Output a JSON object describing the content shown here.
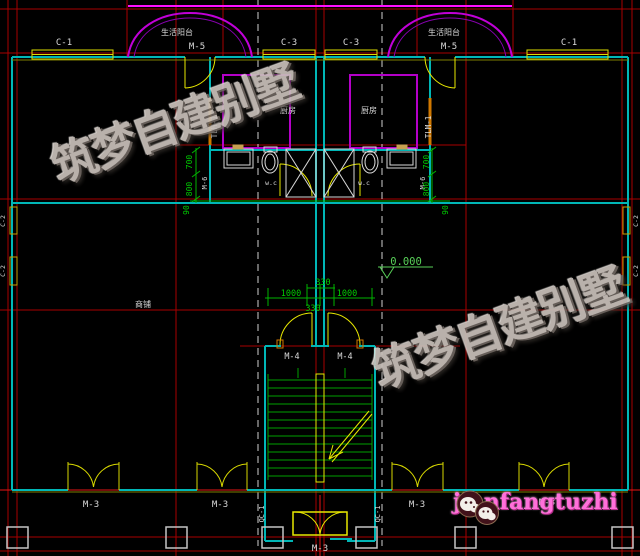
{
  "palette": {
    "background": "#000000",
    "grid_red": "#a80000",
    "bright_red": "#e81616",
    "wall_cyan": "#00b6b6",
    "window_yellow": "#dede00",
    "door_orange": "#d07800",
    "dim_green": "#00b400",
    "balcony_magenta": "#c000d8",
    "accent_magenta": "#ff10ff",
    "text_white": "#dadada",
    "watermark_gray": "#c7bfb9",
    "logo_pink": "#ff70da",
    "column_gray": "#c4c4c4"
  },
  "top": {
    "c1_left": "C-1",
    "balcony_left": "生活阳台",
    "m5_left": "M-5",
    "c3_left": "C-3",
    "c3_right": "C-3",
    "balcony_right": "生活阳台",
    "m5_right": "M-5",
    "c1_right": "C-1"
  },
  "rooms": {
    "kitchen_left": "厨房",
    "kitchen_right": "厨房",
    "shop": "商铺",
    "wc_left": "w.c",
    "wc_right": "w.c"
  },
  "doors": {
    "tlm_left": "TLM-1",
    "tlm_right": "TLM-1",
    "m6_left": "M-6",
    "m6_right": "M-6",
    "m4_left": "M-4",
    "m4_right": "M-4",
    "m3_1": "M-3",
    "m3_2": "M-3",
    "m3_3": "M-3",
    "m3_4": "M-3",
    "m3_center": "M-3",
    "qc_left": "QC-1",
    "qc_right": "QC-1"
  },
  "side_windows": {
    "left_upper": "C-2",
    "left_lower": "C-2",
    "right_upper": "C-2",
    "right_lower": "C-2"
  },
  "dims": {
    "left_700": "700",
    "left_800": "800",
    "left_90": "90",
    "right_700": "700",
    "right_800": "800",
    "right_90": "90",
    "center_330_top": "330",
    "center_1000_left": "1000",
    "center_1000_right": "1000",
    "center_330_bottom": "330",
    "level": "0.000"
  },
  "watermarks": {
    "text1": "筑梦自建别墅",
    "text2": "筑梦自建别墅"
  },
  "logo": {
    "text": "jianfangtuzhi"
  }
}
